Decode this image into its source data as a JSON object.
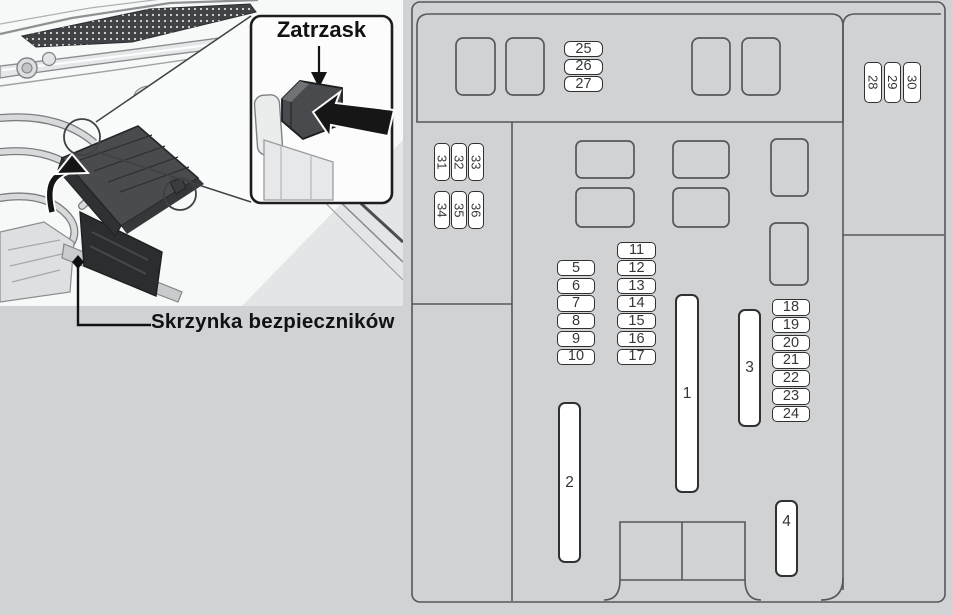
{
  "illustration": {
    "caption": "Skrzynka bezpieczników",
    "callout_label": "Zatrzask"
  },
  "fuse_diagram": {
    "groups": [
      {
        "id": "top-trio",
        "orientation": "horizontal",
        "labels": [
          "25",
          "26",
          "27"
        ]
      },
      {
        "id": "right-trio",
        "orientation": "rotated",
        "labels": [
          "28",
          "29",
          "30"
        ]
      },
      {
        "id": "left-row-1",
        "orientation": "rotated",
        "labels": [
          "31",
          "32",
          "33"
        ]
      },
      {
        "id": "left-row-2",
        "orientation": "rotated",
        "labels": [
          "34",
          "35",
          "36"
        ]
      },
      {
        "id": "col-a",
        "orientation": "horizontal",
        "labels": [
          "5",
          "6",
          "7",
          "8",
          "9",
          "10"
        ]
      },
      {
        "id": "col-b",
        "orientation": "horizontal",
        "labels": [
          "11",
          "12",
          "13",
          "14",
          "15",
          "16",
          "17"
        ]
      },
      {
        "id": "col-c",
        "orientation": "horizontal",
        "labels": [
          "18",
          "19",
          "20",
          "21",
          "22",
          "23",
          "24"
        ]
      }
    ],
    "big_fuses": [
      {
        "label": "1"
      },
      {
        "label": "2"
      },
      {
        "label": "3"
      },
      {
        "label": "4"
      }
    ]
  },
  "colors": {
    "background": "#d1d2d3",
    "panel": "#f7f8f8",
    "outline": "#55575a",
    "fuse_border": "#2f3133",
    "fuse_fill": "#ffffff",
    "label_text": "#353638",
    "ink": "#111214"
  }
}
